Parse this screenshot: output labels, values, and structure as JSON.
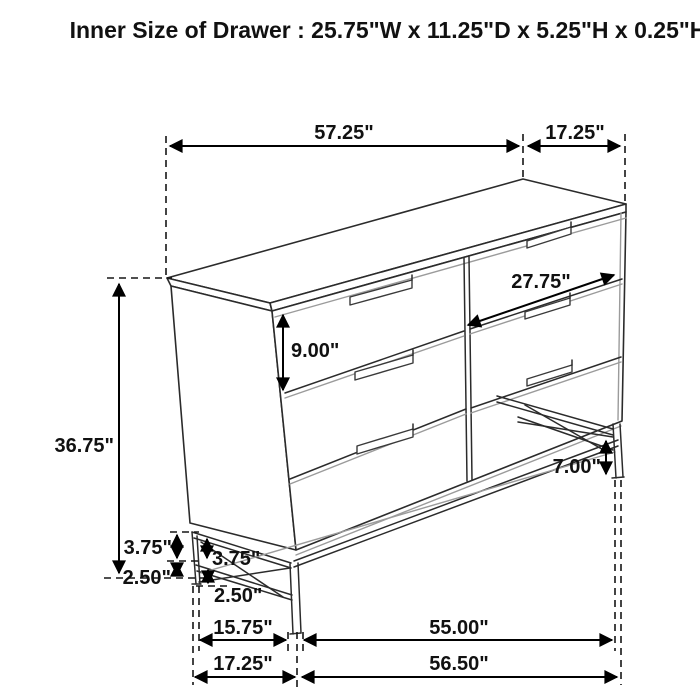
{
  "title": "Inner Size of Drawer : 25.75\"W x 11.25\"D x 5.25\"H x 0.25\"H",
  "dims": {
    "top_width": "57.25\"",
    "top_depth": "17.25\"",
    "drawer_width": "27.75\"",
    "drawer_height": "9.00\"",
    "overall_height": "36.75\"",
    "leg_height": "7.00\"",
    "frame_upper_outer": "3.75\"",
    "frame_upper_inner": "3.75\"",
    "frame_lower_outer": "2.50\"",
    "frame_lower_inner": "2.50\"",
    "leg_span": "15.75\"",
    "base_width": "17.25\"",
    "inner_span": "55.00\"",
    "outer_span": "56.50\""
  },
  "colors": {
    "line": "#2b2b2b",
    "secondary_line": "#9b9b9b",
    "dimension": "#000000",
    "background": "#ffffff"
  }
}
